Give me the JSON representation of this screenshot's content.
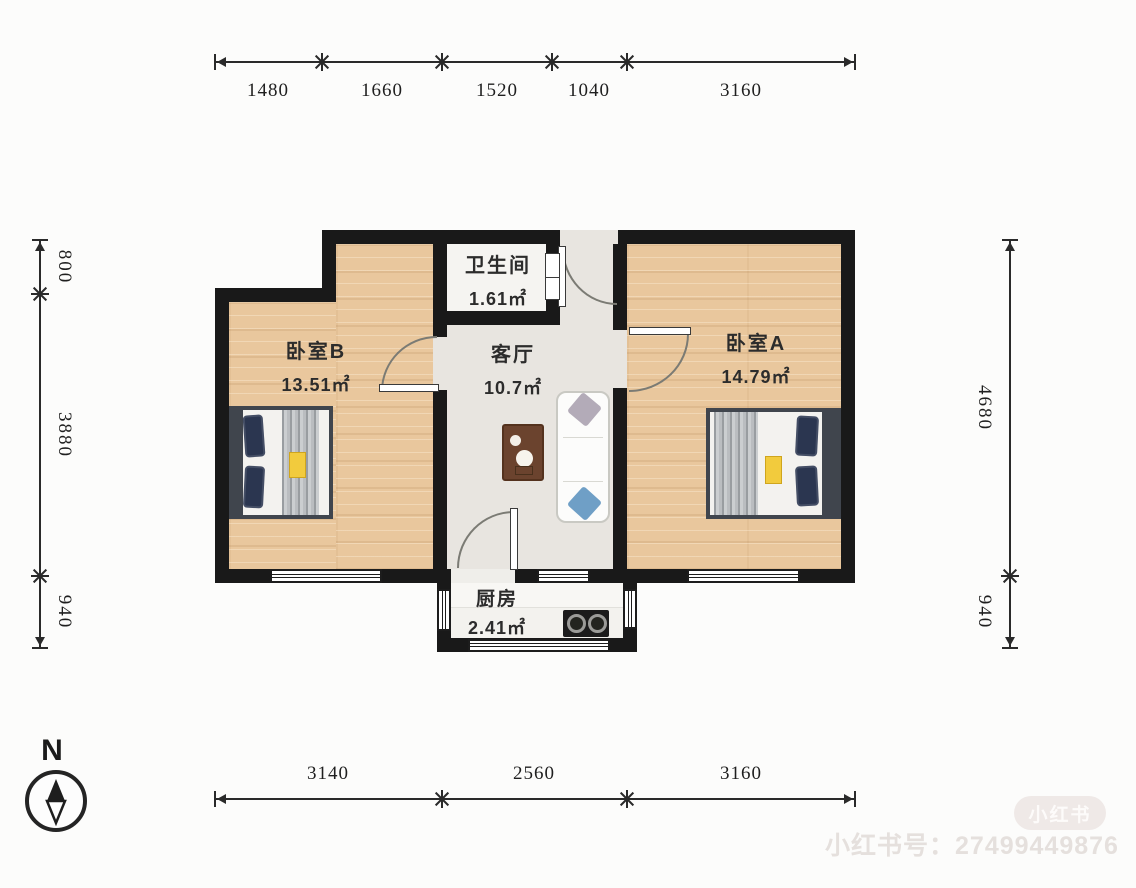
{
  "plan": {
    "rooms": {
      "bedroom_b": {
        "name": "卧室B",
        "area": "13.51㎡"
      },
      "bathroom": {
        "name": "卫生间",
        "area": "1.61㎡"
      },
      "living": {
        "name": "客厅",
        "area": "10.7㎡"
      },
      "bedroom_a": {
        "name": "卧室A",
        "area": "14.79㎡"
      },
      "kitchen": {
        "name": "厨房",
        "area": "2.41㎡"
      }
    }
  },
  "dimensions": {
    "top": [
      "1480",
      "1660",
      "1520",
      "1040",
      "3160"
    ],
    "bottom": [
      "3140",
      "2560",
      "3160"
    ],
    "left": [
      "800",
      "3880",
      "940"
    ],
    "right": [
      "4680",
      "940"
    ]
  },
  "compass": {
    "label": "N"
  },
  "watermark": {
    "badge": "小红书",
    "account_line": "小红书号：27499449876"
  },
  "colors": {
    "wall": "#191919",
    "wood_floor": "#e9c79d",
    "living_floor": "#e8e5e0",
    "accent_tag": "#f2cb3d"
  }
}
